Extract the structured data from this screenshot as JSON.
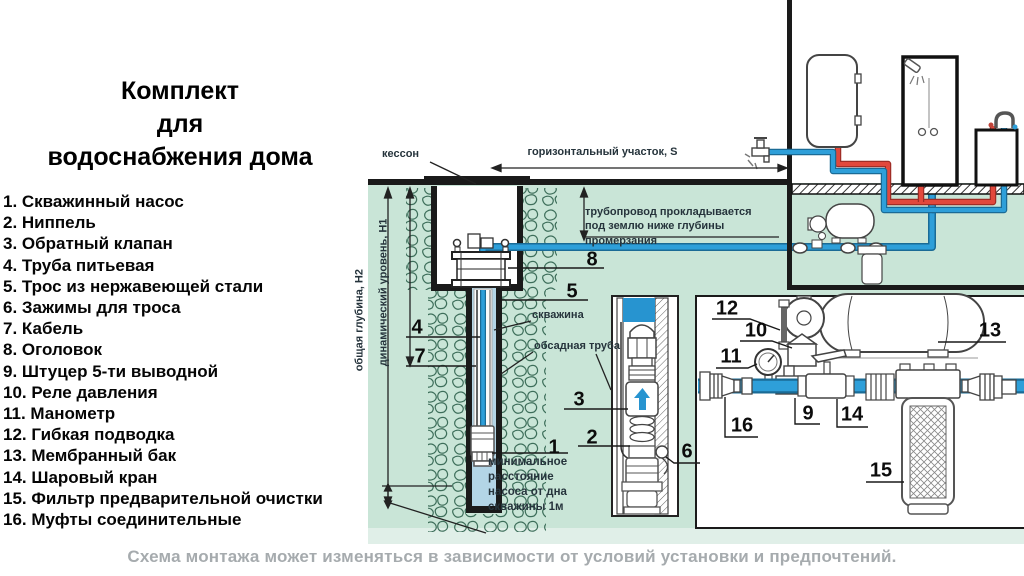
{
  "title": "Комплект\nдля\nводоснабжения дома",
  "legend": {
    "items": [
      "1. Скважинный насос",
      "2. Ниппель",
      "3. Обратный клапан",
      "4. Труба питьевая",
      "5. Трос из нержавеющей стали",
      "6. Зажимы для троса",
      "7. Кабель",
      "8. Оголовок",
      "9. Штуцер 5-ти выводной",
      "10. Реле давления",
      "11. Манометр",
      "12. Гибкая подводка",
      "13. Мембранный бак",
      "14. Шаровый кран",
      "15. Фильтр предварительной очистки",
      "16. Муфты соединительные"
    ]
  },
  "diagram": {
    "labels": {
      "kesson": "кессон",
      "horizontal_section": "горизонтальный участок, S",
      "pipeline_note": "трубопровод прокладывается\nпод землю ниже глубины промерзания",
      "total_depth": "общая глубина, Н2",
      "dynamic_level": "динамический уровень, Н1",
      "well": "скважина",
      "casing_pipe": "обсадная труба",
      "min_distance": "минимальное\nрасстояние\nнасоса от дна\nскважины 1м"
    },
    "callouts": {
      "n1": "1",
      "n2": "2",
      "n3": "3",
      "n4": "4",
      "n5": "5",
      "n6": "6",
      "n7": "7",
      "n8": "8",
      "n9": "9",
      "n10": "10",
      "n11": "11",
      "n12": "12",
      "n13": "13",
      "n14": "14",
      "n15": "15",
      "n16": "16"
    }
  },
  "caption": "Схема монтажа может изменяться в зависимости от условий установки и предпочтений.",
  "colors": {
    "underground_green": "#c9e5d7",
    "underground_light": "#e0efe8",
    "pipe_blue": "#2e9fd9",
    "pipe_blue_dark": "#1a6b96",
    "pipe_red": "#e2483c",
    "water_light_blue": "#b3d5e6",
    "line_black": "#1a1a1a",
    "soil_stroke": "#3d6e5a",
    "caption_gray": "#a6abae"
  }
}
